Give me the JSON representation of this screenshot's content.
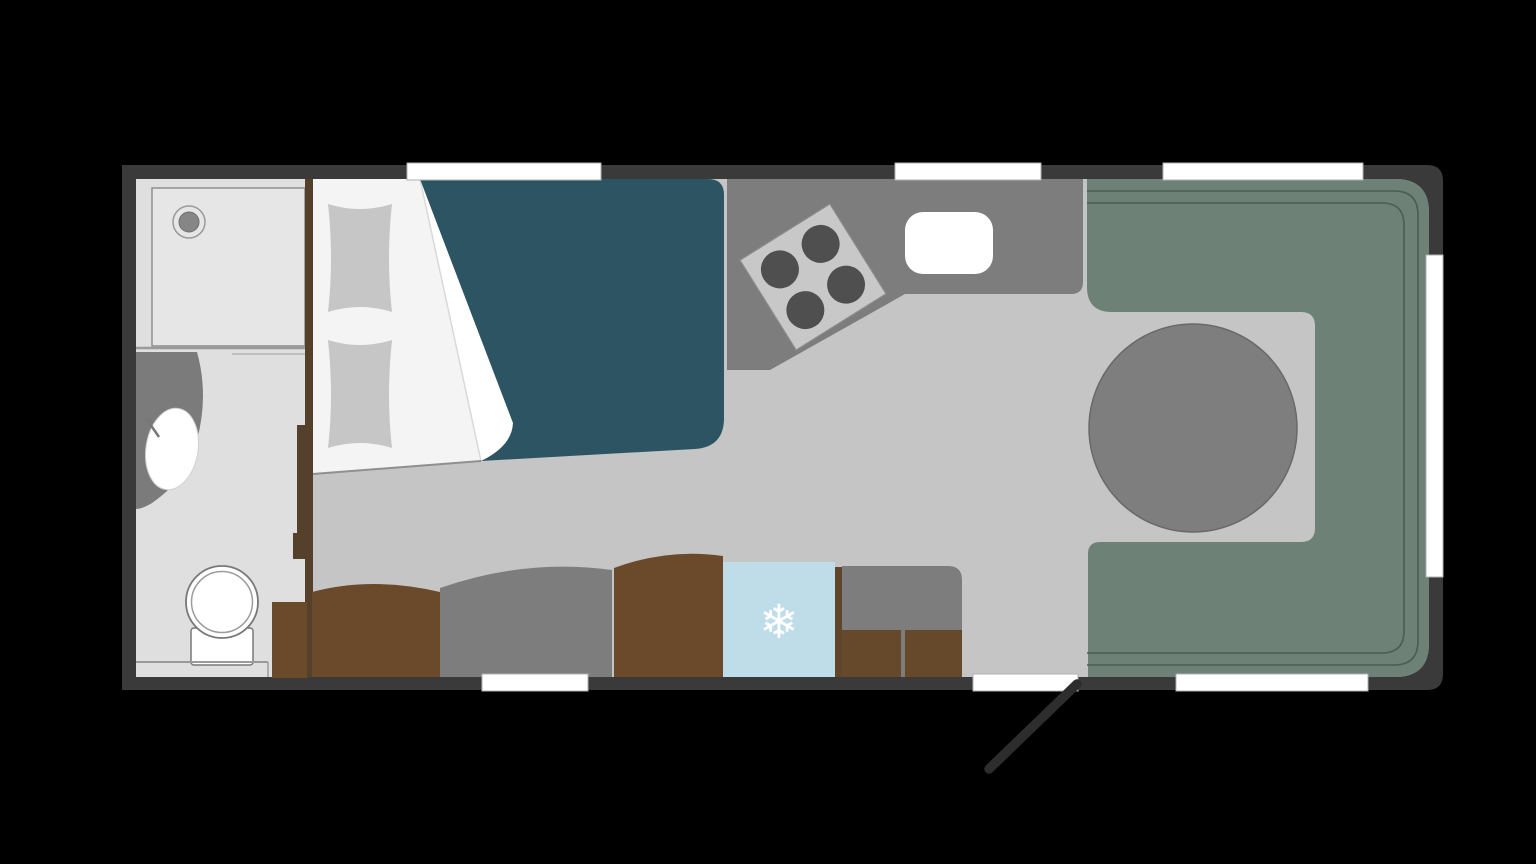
{
  "scene": {
    "description": "Caravan / motorhome floor plan, top-down view, on a black background",
    "background_color": "#000000"
  },
  "floorplan": {
    "wall_color": "#3a3a3a",
    "floor_color": "#c5c5c5",
    "window_color": "#ffffff",
    "openings": {
      "windows_top": 3,
      "windows_bottom": 2,
      "windows_right": 1,
      "entry_doors": 1
    },
    "bathroom": {
      "floor_color": "#dfdfdf",
      "shower_tray_color": "#e6e6e6",
      "counter_color": "#7b7b7b",
      "fixtures": [
        "shower tray with drain",
        "washbasin with faucet",
        "toilet"
      ]
    },
    "bedroom": {
      "mattress_color": "#f4f4f4",
      "fold_color": "#ffffff",
      "duvet_color": "#2c5462",
      "pillow_color": "#c6c6c6",
      "fixtures": [
        "french bed",
        "pillow",
        "pillow",
        "duvet folded back"
      ]
    },
    "kitchen": {
      "counter_color": "#7d7d7d",
      "hob_color": "#c8c8c8",
      "burner_color": "#4f4f4f",
      "burner_count": 4,
      "sink_color": "#ffffff",
      "fixtures": [
        "angled kitchen counter",
        "hob with 4 burners",
        "sink"
      ]
    },
    "seating": {
      "seat_colors": [
        "#6b4a2c",
        "#7d7d7d",
        "#6b4a2c"
      ],
      "fixtures": [
        "side seat",
        "side seat",
        "side seat"
      ]
    },
    "refrigerator": {
      "body_color": "#bfdde9",
      "snowflake_glyph": "❄",
      "snowflake_color": "#ffffff"
    },
    "storage": {
      "wardrobe_color": "#7d7d7d",
      "cabinet_color": "#66482b",
      "partition_color": "#55412b",
      "fixtures": [
        "wardrobe",
        "cabinet",
        "cabinet",
        "partition wall",
        "bathroom sliding door",
        "storage box"
      ]
    },
    "dinette": {
      "sofa_color": "#6d8177",
      "backrest_line_color": "#4c5d54",
      "table_color": "#7e7e7e",
      "fixtures": [
        "U-shaped rear lounge",
        "round dining table"
      ]
    },
    "door": {
      "leaf_color": "#2d2d2d",
      "state": "open"
    }
  }
}
